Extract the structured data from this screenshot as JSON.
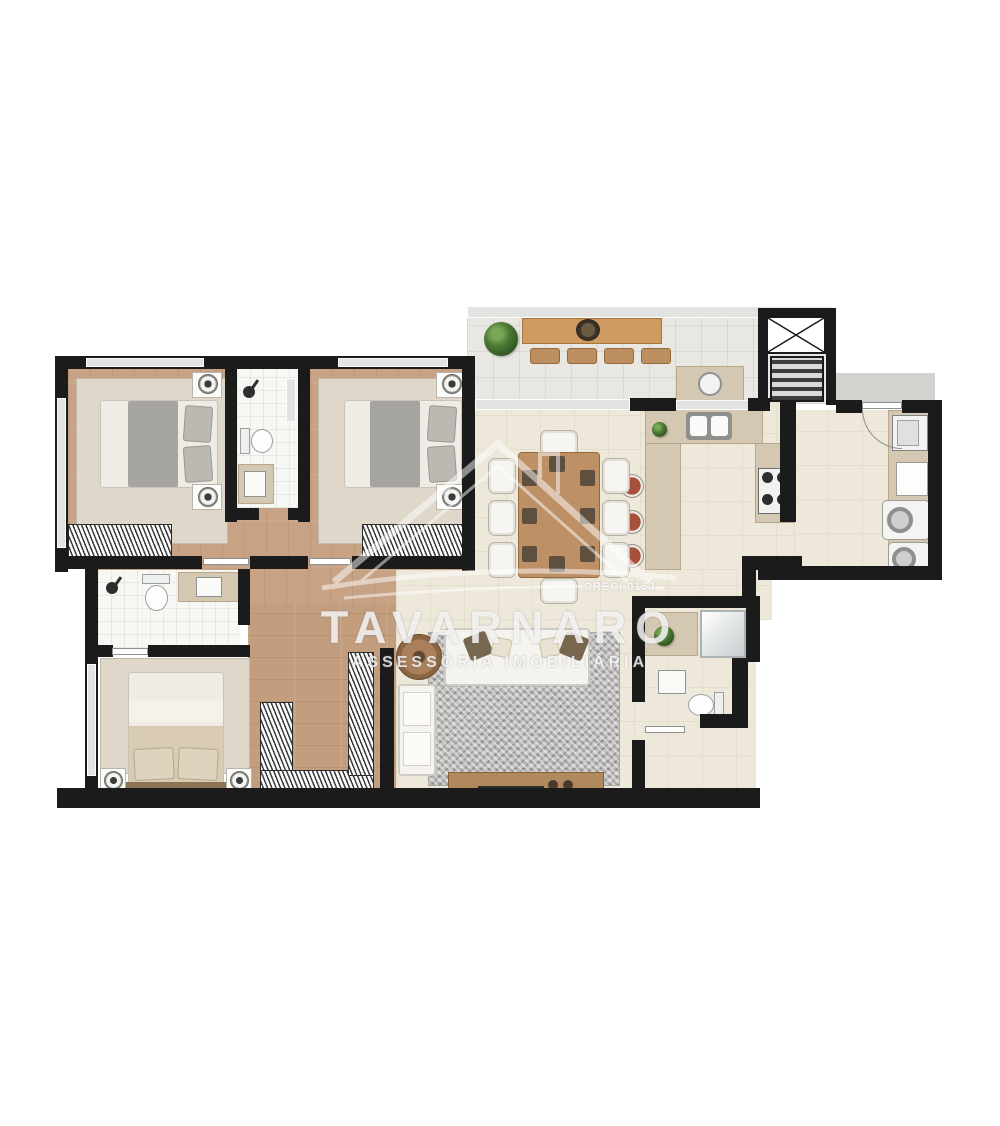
{
  "watermark": {
    "brand": "TAVARNARO",
    "tagline": "ASSESSORIA IMOBILIÁRIA",
    "license": "CRECI 015J"
  },
  "palette": {
    "wall": "#1b1b1b",
    "wood_floor": "#c7a284",
    "cream_tile": "#eee8da",
    "terrace_tile": "#e8e7e2",
    "bath_tile": "#f7f7f4",
    "counter_tan": "#d5c8b2",
    "bbq_counter": "#d09a63",
    "dining_table": "#bd9066",
    "living_rug": "#c6c5c3",
    "bedroom_rug": "#ded7ca",
    "stool_rust": "#a8503c",
    "plant_green": "#4d7a35",
    "hall_gray": "#d3d2cf"
  },
  "icons": {
    "elevator": "shaft box with X cross",
    "stairs": "striped gradient strip",
    "stove": "4-burner cooktop",
    "double-sink": "two basins",
    "washer": "round door machine",
    "shower": "head with arm",
    "grill": "round barbecue on counter"
  }
}
